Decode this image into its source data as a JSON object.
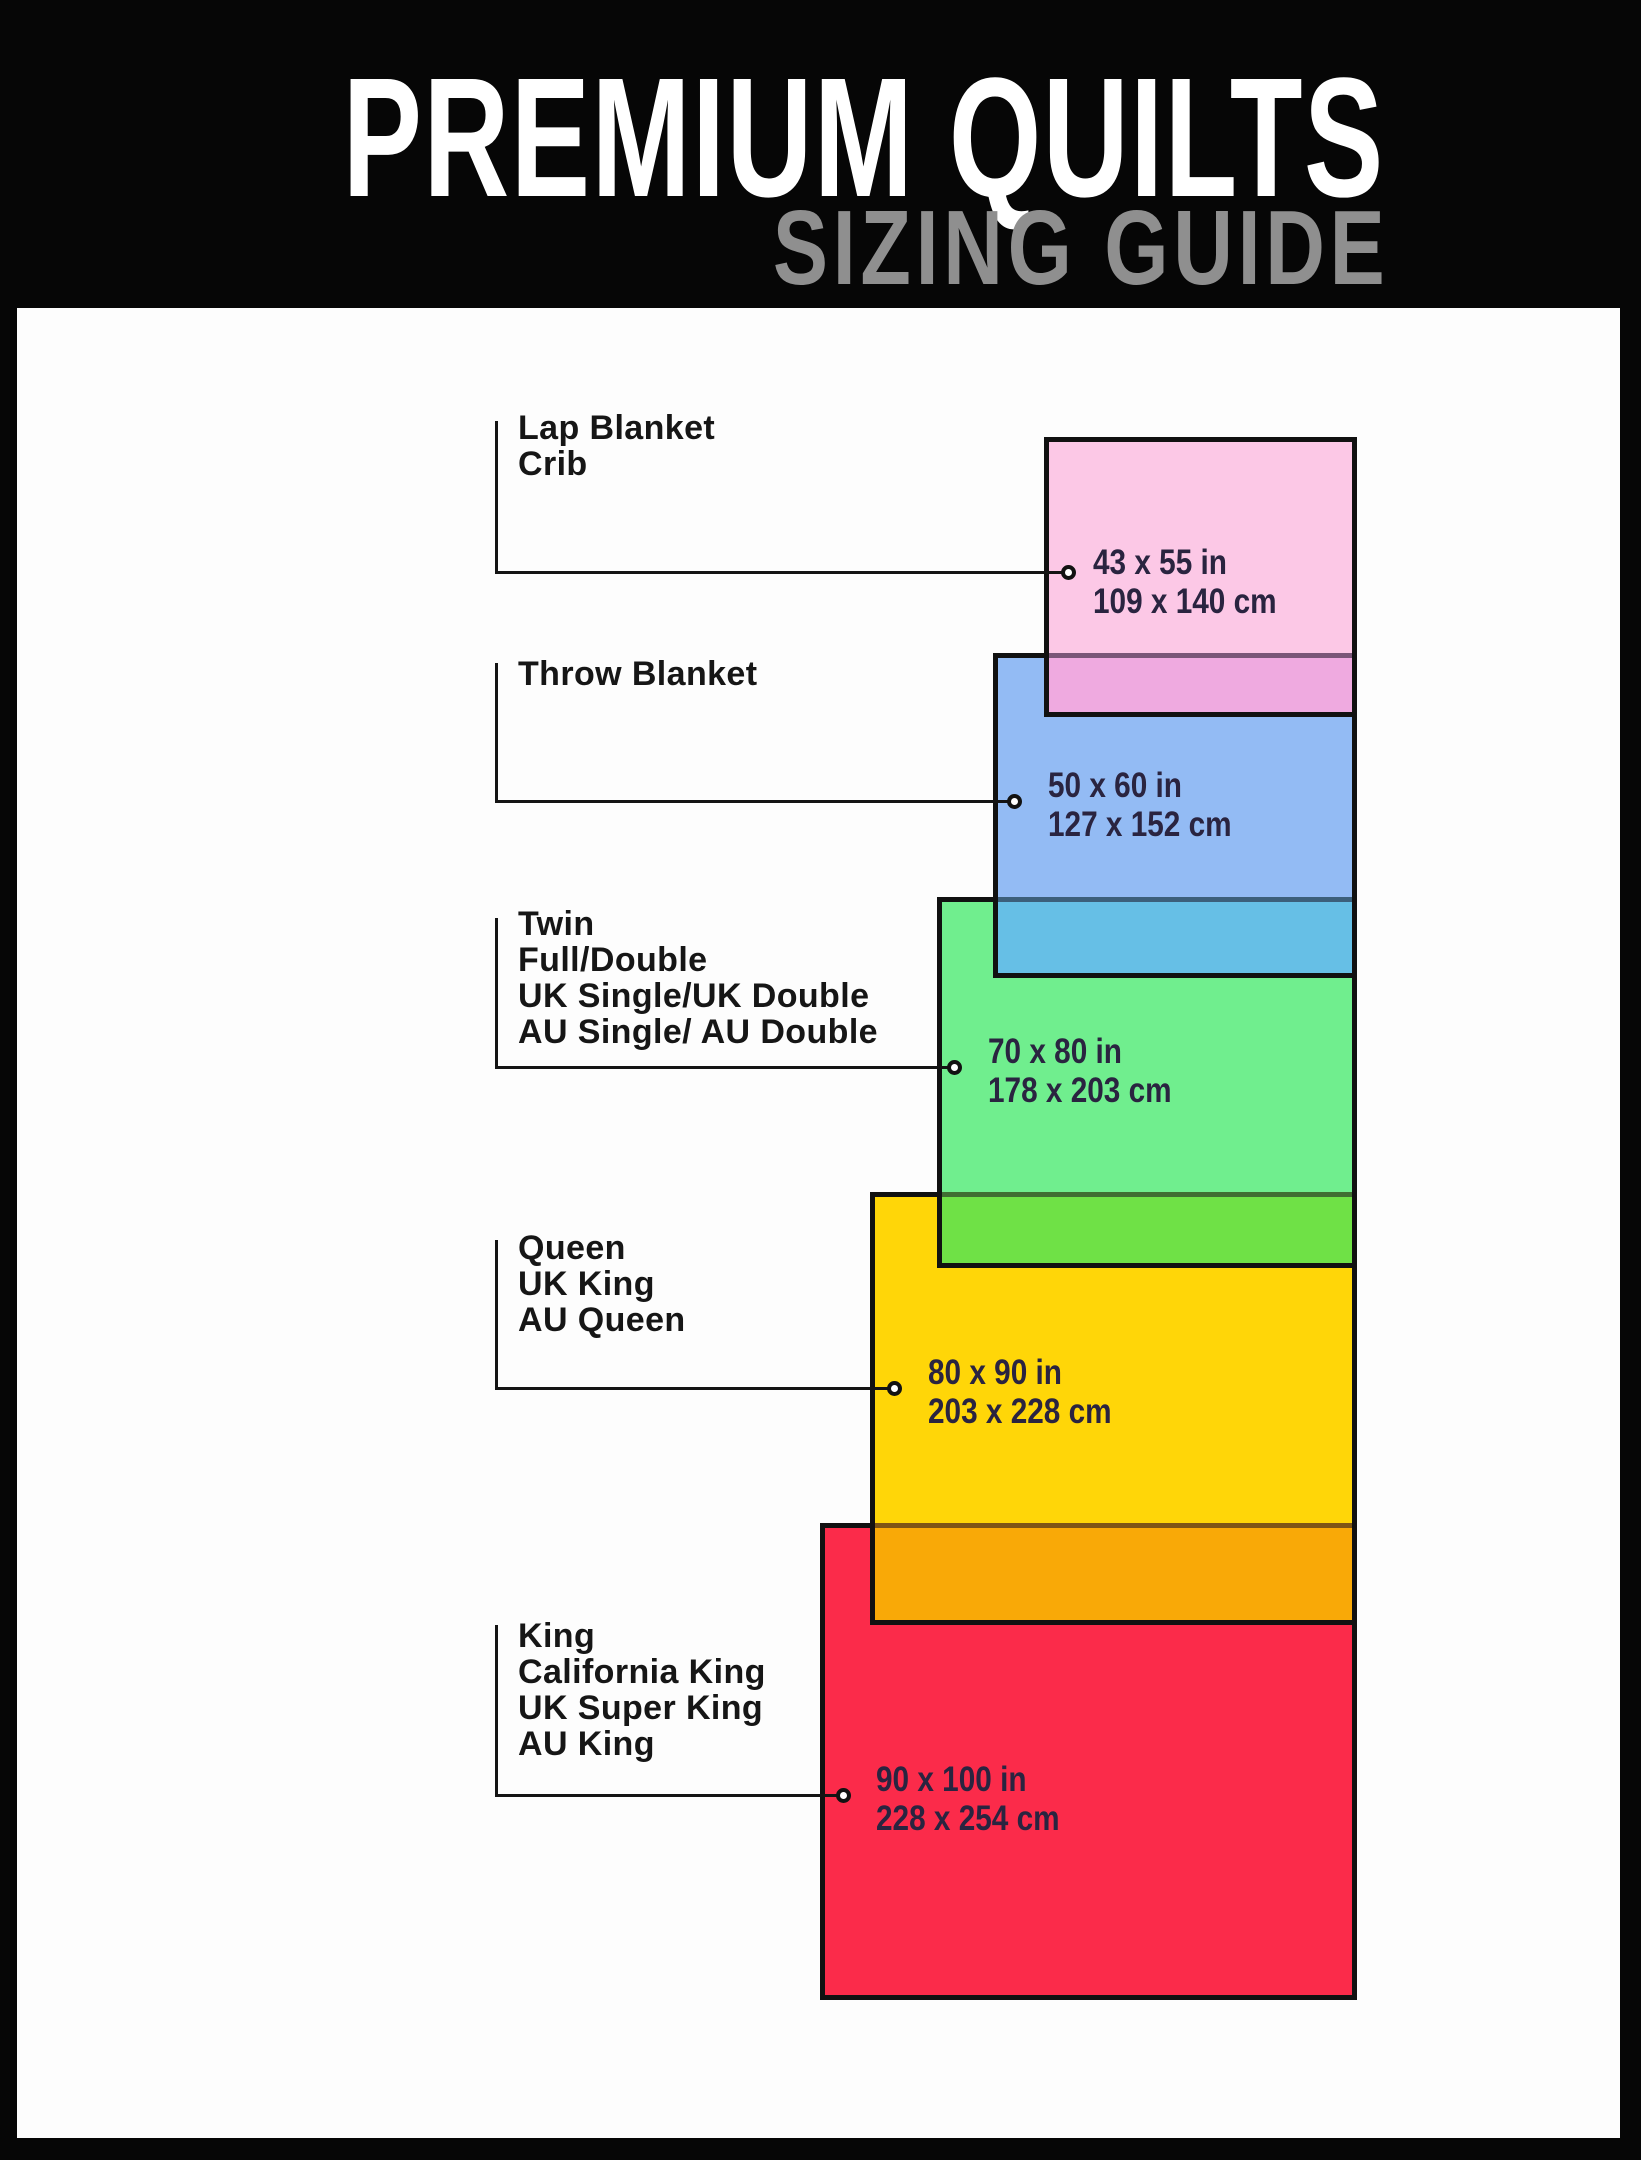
{
  "header": {
    "title": "PREMIUM QUILTS",
    "subtitle": "SIZING GUIDE",
    "background_color": "#060606",
    "title_color": "#ffffff",
    "subtitle_color": "#8f8f8f"
  },
  "panel_color": "#fdfdfd",
  "line_color": "#141414",
  "sizes": [
    {
      "id": "lap-blanket-crib",
      "labels": [
        "Lap Blanket",
        "Crib"
      ],
      "inches": "43 x 55 in",
      "cm": "109 x 140 cm",
      "fill": "#fcc8e6",
      "overlap_fill": "#efaae0"
    },
    {
      "id": "throw-blanket",
      "labels": [
        "Throw Blanket"
      ],
      "inches": "50 x 60 in",
      "cm": "127 x 152 cm",
      "fill": "#93bbf4",
      "overlap_fill": "#66bfe6"
    },
    {
      "id": "twin-full-double",
      "labels": [
        "Twin",
        "Full/Double",
        "UK Single/UK Double",
        "AU Single/ AU Double"
      ],
      "inches": "70 x 80 in",
      "cm": "178 x 203 cm",
      "fill": "#70ee8e",
      "overlap_fill": "#6fe146"
    },
    {
      "id": "queen",
      "labels": [
        "Queen",
        "UK King",
        "AU Queen"
      ],
      "inches": "80 x 90 in",
      "cm": "203 x 228 cm",
      "fill": "#ffd608",
      "overlap_fill": "#f9a907"
    },
    {
      "id": "king",
      "labels": [
        "King",
        "California King",
        "UK Super King",
        "AU King"
      ],
      "inches": "90 x 100 in",
      "cm": "228 x 254 cm",
      "fill": "#fb2b4a",
      "overlap_fill": ""
    }
  ]
}
